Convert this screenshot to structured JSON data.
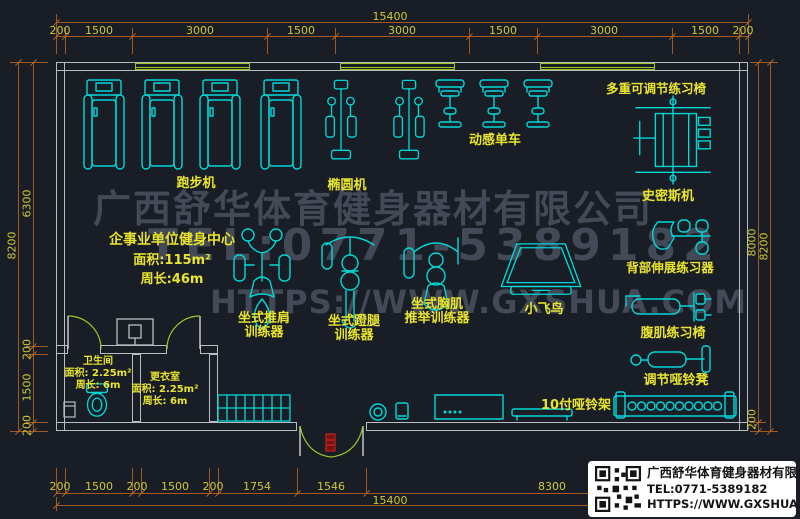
{
  "watermark": {
    "line1": "广西舒华体育健身器材有限公司",
    "line2": "TEL:0771-5389182",
    "line3": "HTTPS://WWW.GXSHUA.COM"
  },
  "info": {
    "title": "企事业单位健身中心",
    "area": "面积:115m²",
    "perimeter": "周长:46m"
  },
  "rooms": {
    "toilet": {
      "name": "卫生间",
      "area": "面积: 2.25m²",
      "perimeter": "周长: 6m"
    },
    "changing": {
      "name": "更衣室",
      "area": "面积: 2.25m²",
      "perimeter": "周长: 6m"
    }
  },
  "labels": {
    "treadmill": "跑步机",
    "elliptical": "椭圆机",
    "spin_bike": "动感单车",
    "multi_chair": "多重可调节练习椅",
    "smith": "史密斯机",
    "back_extension": "背部伸展练习器",
    "ab_chair": "腹肌练习椅",
    "dumbbell_bench": "调节哑铃凳",
    "fly_bird": "小飞鸟",
    "shoulder_press_1": "坐式推肩",
    "shoulder_press_2": "训练器",
    "leg_press_1": "坐式蹬腿",
    "leg_press_2": "训练器",
    "chest_press_1": "坐式胸肌",
    "chest_press_2": "推举训练器",
    "dumbbell_rack": "10付哑铃架"
  },
  "dimensions": {
    "top_total": "15400",
    "top_segments": [
      "200",
      "1500",
      "3000",
      "1500",
      "3000",
      "1500",
      "3000",
      "1500",
      "200"
    ],
    "bottom_segments": [
      "200",
      "1500",
      "200",
      "1500",
      "200",
      "1754",
      "1546",
      "8300",
      "200"
    ],
    "bottom_total": "15400",
    "left_outer": "8200",
    "left_segments": [
      "6300",
      "200",
      "1500",
      "200"
    ],
    "right_inner": "8000",
    "right_outer": "8200",
    "right_bottom": "200"
  },
  "title_block": {
    "company": "广西舒华体育健身器材有限公司",
    "tel": "TEL:0771-5389182",
    "url": "HTTPS://WWW.GXSHUA.COM"
  },
  "colors": {
    "background": "#191d26",
    "equipment_cyan": "#00d8d8",
    "label_yellow": "#e9e52e",
    "dim_line_orange": "#a4591f",
    "dim_text_yellow": "#cfc832",
    "wall_gray": "#b9bec4",
    "window_green": "#9ec622",
    "entrance_red": "#c22222",
    "watermark_gray": "#434956"
  }
}
